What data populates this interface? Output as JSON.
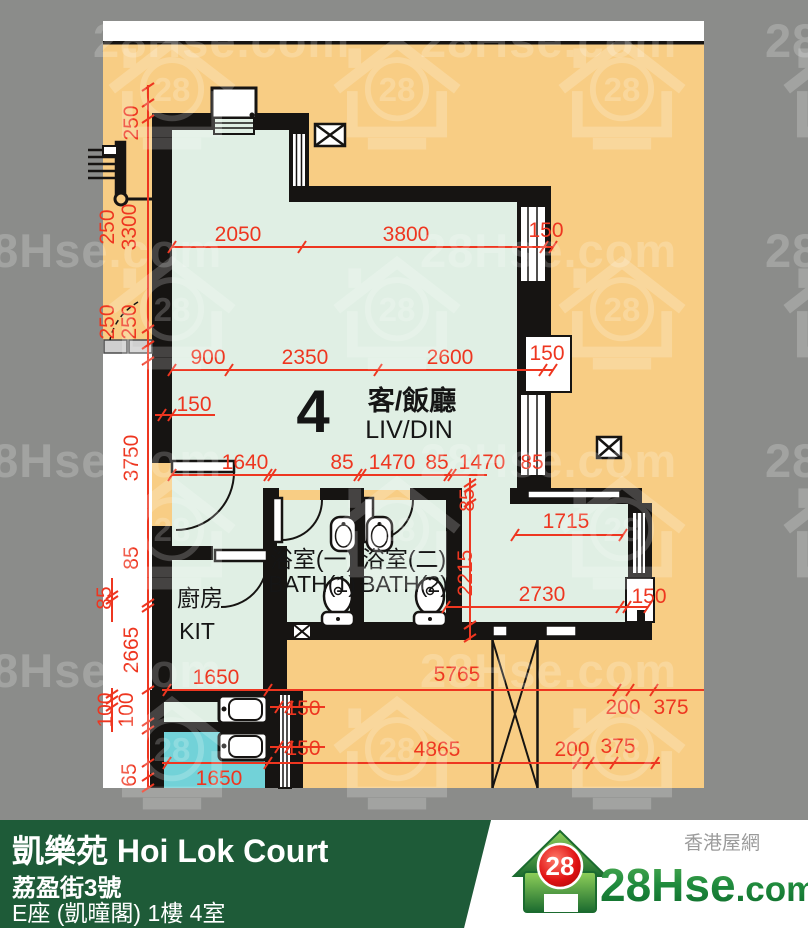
{
  "colors": {
    "canvas_gray": "#8b8c8a",
    "plan_orange": "#f8cd84",
    "room_green": "#e0efe4",
    "room_teal": "#72d2d8",
    "dim_red": "#ee3620",
    "wall_black": "#161412",
    "footer_green": "#1e5b38",
    "logo_green": "#1f8a3d",
    "logo_red": "#d40f12"
  },
  "watermark": {
    "text": "28Hse.com",
    "badge": "28",
    "text_positions": [
      [
        93,
        57
      ],
      [
        420,
        57
      ],
      [
        765,
        57
      ],
      [
        -35,
        267
      ],
      [
        420,
        267
      ],
      [
        765,
        267
      ],
      [
        -35,
        477
      ],
      [
        420,
        477
      ],
      [
        765,
        477
      ],
      [
        -35,
        687
      ],
      [
        420,
        687
      ]
    ],
    "icon_positions": [
      [
        172,
        97
      ],
      [
        397,
        97
      ],
      [
        622,
        97
      ],
      [
        847,
        97
      ],
      [
        172,
        317
      ],
      [
        397,
        317
      ],
      [
        622,
        317
      ],
      [
        847,
        317
      ],
      [
        172,
        537
      ],
      [
        397,
        537
      ],
      [
        622,
        537
      ],
      [
        847,
        537
      ],
      [
        172,
        757
      ],
      [
        397,
        757
      ],
      [
        622,
        757
      ]
    ]
  },
  "plan": {
    "unit_number": "4",
    "room_labels": [
      {
        "t": "4",
        "x": 313,
        "y": 432,
        "cls": "r-big"
      },
      {
        "t": "客/飯廳",
        "x": 412,
        "y": 410,
        "cls": "r-zh"
      },
      {
        "t": "LIV/DIN",
        "x": 409,
        "y": 438,
        "cls": "r-en"
      },
      {
        "t": "浴室(一)",
        "x": 312,
        "y": 567,
        "cls": "r-sm"
      },
      {
        "t": "BATH(1)",
        "x": 312,
        "y": 592,
        "cls": "r-sm"
      },
      {
        "t": "浴室(二)",
        "x": 404,
        "y": 567,
        "cls": "r-sm"
      },
      {
        "t": "BATH(2)",
        "x": 404,
        "y": 592,
        "cls": "r-sm"
      },
      {
        "t": "廚房",
        "x": 200,
        "y": 606,
        "cls": "r-sm"
      },
      {
        "t": "KIT",
        "x": 197,
        "y": 639,
        "cls": "r-sm"
      }
    ],
    "dim_labels": [
      {
        "t": "250",
        "x": 138,
        "y": 123,
        "r": 1
      },
      {
        "t": "250",
        "x": 114,
        "y": 227,
        "r": 1
      },
      {
        "t": "3300",
        "x": 136,
        "y": 227,
        "r": 1
      },
      {
        "t": "250",
        "x": 114,
        "y": 322,
        "r": 1
      },
      {
        "t": "250",
        "x": 136,
        "y": 322,
        "r": 1
      },
      {
        "t": "3750",
        "x": 138,
        "y": 458,
        "r": 1
      },
      {
        "t": "85",
        "x": 138,
        "y": 558,
        "r": 1
      },
      {
        "t": "85",
        "x": 111,
        "y": 598,
        "r": 1
      },
      {
        "t": "2665",
        "x": 138,
        "y": 650,
        "r": 1
      },
      {
        "t": "100",
        "x": 112,
        "y": 710,
        "r": 1
      },
      {
        "t": "100",
        "x": 133,
        "y": 710,
        "r": 1
      },
      {
        "t": "65",
        "x": 136,
        "y": 775,
        "r": 1
      },
      {
        "t": "2050",
        "x": 238,
        "y": 241
      },
      {
        "t": "3800",
        "x": 406,
        "y": 241
      },
      {
        "t": "150",
        "x": 546,
        "y": 237
      },
      {
        "t": "900",
        "x": 208,
        "y": 364
      },
      {
        "t": "2350",
        "x": 305,
        "y": 364
      },
      {
        "t": "2600",
        "x": 450,
        "y": 364
      },
      {
        "t": "150",
        "x": 547,
        "y": 360
      },
      {
        "t": "150",
        "x": 194,
        "y": 411
      },
      {
        "t": "1640",
        "x": 245,
        "y": 469
      },
      {
        "t": "85",
        "x": 342,
        "y": 469
      },
      {
        "t": "1470",
        "x": 392,
        "y": 469
      },
      {
        "t": "85",
        "x": 437,
        "y": 469
      },
      {
        "t": "1470",
        "x": 482,
        "y": 469
      },
      {
        "t": "85",
        "x": 532,
        "y": 469
      },
      {
        "t": "85",
        "x": 474,
        "y": 500,
        "r": 1
      },
      {
        "t": "2215",
        "x": 472,
        "y": 573,
        "r": 1
      },
      {
        "t": "1715",
        "x": 566,
        "y": 528
      },
      {
        "t": "2730",
        "x": 542,
        "y": 601
      },
      {
        "t": "150",
        "x": 649,
        "y": 603
      },
      {
        "t": "1650",
        "x": 216,
        "y": 684
      },
      {
        "t": "5765",
        "x": 457,
        "y": 681
      },
      {
        "t": "200",
        "x": 623,
        "y": 714
      },
      {
        "t": "375",
        "x": 671,
        "y": 714
      },
      {
        "t": "150",
        "x": 303,
        "y": 715
      },
      {
        "t": "150",
        "x": 303,
        "y": 755
      },
      {
        "t": "1650",
        "x": 219,
        "y": 785
      },
      {
        "t": "4865",
        "x": 437,
        "y": 756
      },
      {
        "t": "200",
        "x": 572,
        "y": 756
      },
      {
        "t": "375",
        "x": 618,
        "y": 753
      }
    ]
  },
  "footer": {
    "line1": "凱樂苑 Hoi Lok Court",
    "line2": "荔盈街3號",
    "line3": "E座 (凱曈閣) 1樓 4室"
  },
  "logo": {
    "site_main": "28Hse",
    "site_suffix": ".com",
    "badge": "28",
    "tagline": "香港屋網"
  }
}
